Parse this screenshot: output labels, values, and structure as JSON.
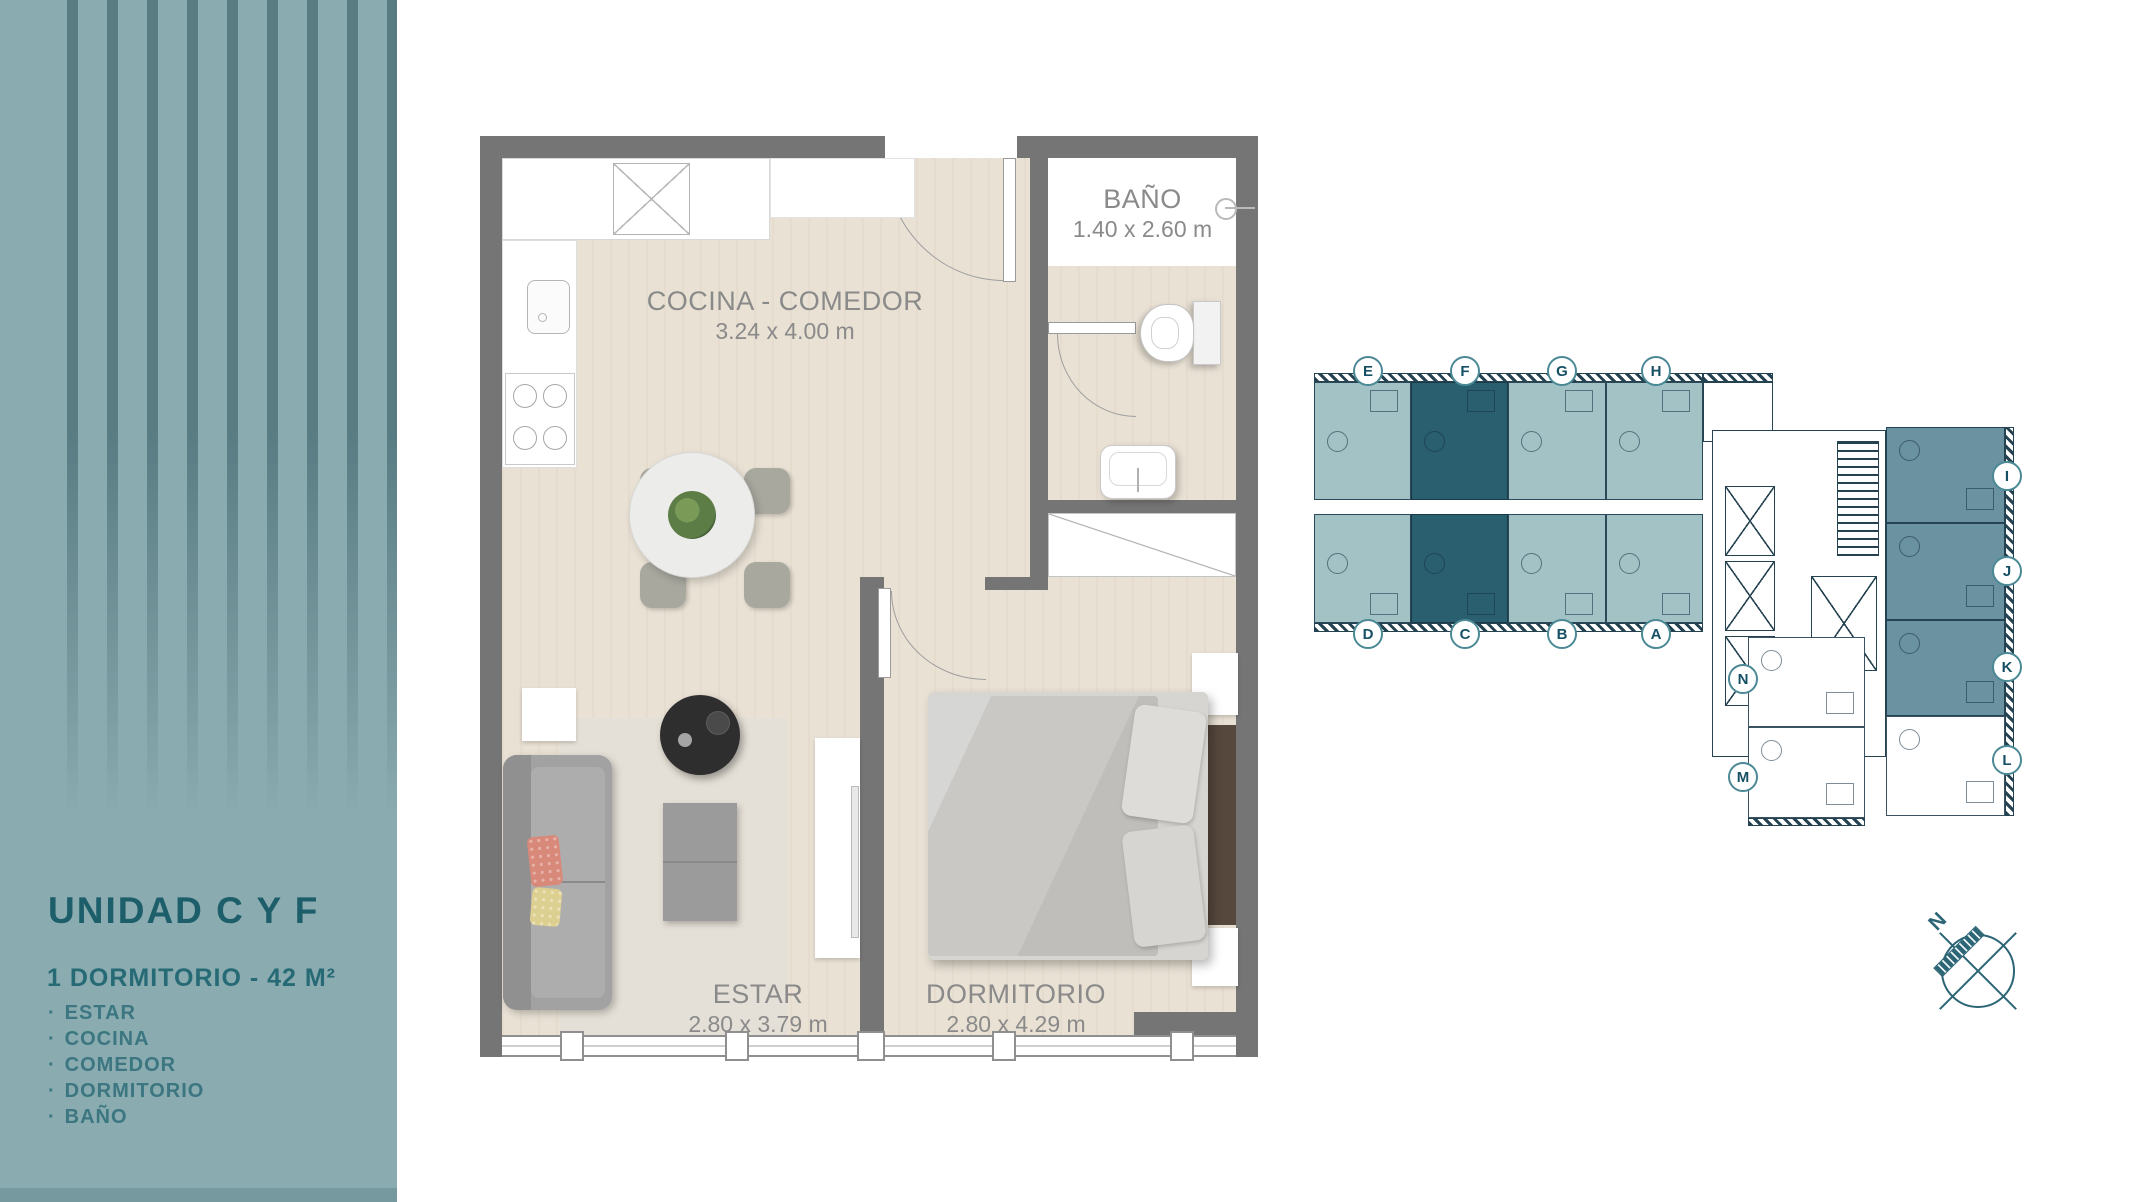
{
  "sidebar": {
    "title": "UNIDAD C Y F",
    "subtitle": "1 DORMITORIO - 42 M²",
    "bullet": "·",
    "features": [
      "ESTAR",
      "COCINA",
      "COMEDOR",
      "DORMITORIO",
      "BAÑO"
    ],
    "colors": {
      "background": "#8aabaf",
      "stripe": "#35616c",
      "title": "#1d5e6b",
      "subtitle": "#266a76",
      "text": "#3b7681",
      "bottom_bar": "#75999e"
    }
  },
  "floorplan": {
    "rooms": [
      {
        "id": "cocina-comedor",
        "name": "COCINA - COMEDOR",
        "dims": "3.24 x 4.00 m"
      },
      {
        "id": "bano",
        "name": "BAÑO",
        "dims": "1.40 x 2.60 m"
      },
      {
        "id": "estar",
        "name": "ESTAR",
        "dims": "2.80 x 3.79 m"
      },
      {
        "id": "dormitorio",
        "name": "DORMITORIO",
        "dims": "2.80 x 4.29 m"
      }
    ],
    "colors": {
      "wall": "#757575",
      "floor": "#e9e1d4",
      "bath_floor": "#ffffff",
      "label": "#8a8a8a",
      "rug": "#e5e0d7",
      "sofa": "#a2a2a2",
      "pillow_coral": "#d9897a",
      "pillow_yellow": "#ddcf8f",
      "round_table_dark": "#2e2e2e",
      "plant": "#5d7d46",
      "bed": "#c9c8c5",
      "headboard": "#56483d"
    }
  },
  "keyplan": {
    "units": [
      {
        "letter": "E",
        "highlighted": false
      },
      {
        "letter": "F",
        "highlighted": true
      },
      {
        "letter": "G",
        "highlighted": false
      },
      {
        "letter": "H",
        "highlighted": false
      },
      {
        "letter": "D",
        "highlighted": false
      },
      {
        "letter": "C",
        "highlighted": true
      },
      {
        "letter": "B",
        "highlighted": false
      },
      {
        "letter": "A",
        "highlighted": false
      },
      {
        "letter": "I",
        "highlighted": false
      },
      {
        "letter": "J",
        "highlighted": false
      },
      {
        "letter": "K",
        "highlighted": false
      },
      {
        "letter": "L",
        "highlighted": false
      },
      {
        "letter": "N",
        "highlighted": false
      },
      {
        "letter": "M",
        "highlighted": false
      }
    ],
    "colors": {
      "unit_light": "#a3c2c5",
      "unit_highlight": "#2a5f6f",
      "unit_medium": "#6b92a0",
      "unit_white": "#ffffff",
      "line": "#24424f",
      "badge_border": "#4a8995",
      "badge_text": "#155064"
    }
  },
  "compass": {
    "label": "N",
    "color": "#2c6575"
  }
}
